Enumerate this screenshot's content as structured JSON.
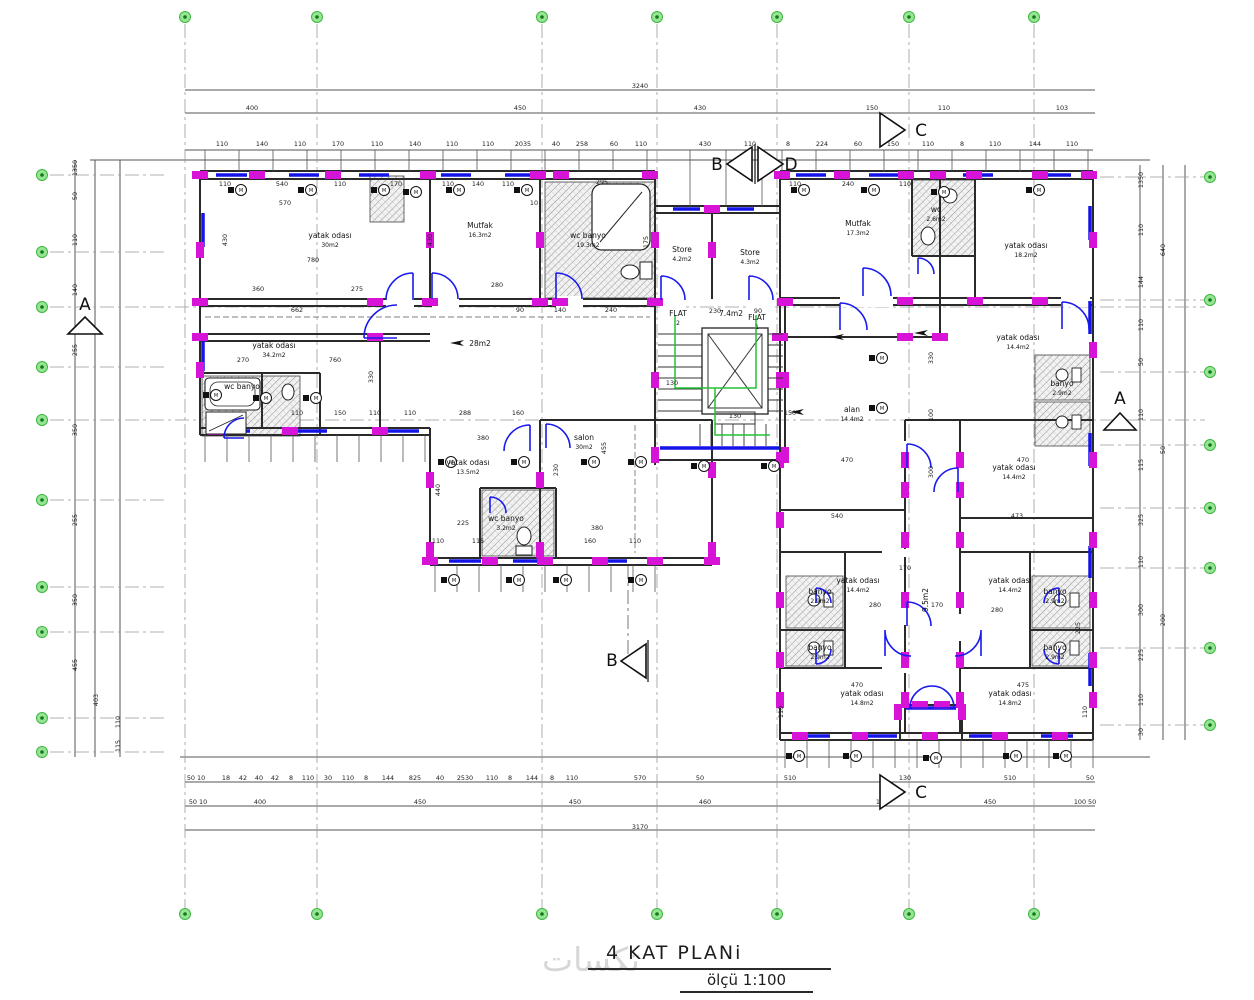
{
  "title": {
    "name": "4 KAT PLANi",
    "scale": "ölçü 1:100"
  },
  "watermark": "تكسات",
  "colors": {
    "wall": "#2a2a2a",
    "column": "#d613d6",
    "window": "#1414e8",
    "door": "#1a1aee",
    "grid_fill": "#97e497",
    "grid_ring": "#3cb83c",
    "grid_dot": "#137a13",
    "escape_path": "#23c035",
    "dim_text": "#1c1c1c",
    "hatch_line": "#8f8f8f",
    "frame": "#555555"
  },
  "icons": {
    "fixture_glyph": "M",
    "direction_arrow": "left-arrow"
  },
  "grid_bubbles": {
    "top": {
      "y": 17,
      "xs": [
        185,
        317,
        542,
        657,
        777,
        909,
        1034
      ]
    },
    "bottom": {
      "y": 914,
      "xs": [
        185,
        317,
        542,
        657,
        777,
        909,
        1034
      ]
    },
    "left": {
      "x": 42,
      "ys": [
        175,
        252,
        307,
        367,
        420,
        500,
        587,
        632,
        718,
        752
      ]
    },
    "right": {
      "x": 1210,
      "ys": [
        177,
        300,
        372,
        445,
        508,
        568,
        648,
        725
      ]
    }
  },
  "section_markers": [
    {
      "label": "A",
      "lx": 85,
      "ly": 310,
      "tri": [
        68,
        334,
        102,
        334,
        85,
        317
      ]
    },
    {
      "label": "A",
      "lx": 1120,
      "ly": 404,
      "tri": [
        1104,
        430,
        1136,
        430,
        1120,
        413
      ]
    },
    {
      "label": "B",
      "lx": 612,
      "ly": 666,
      "tri": [
        646,
        644,
        646,
        678,
        621,
        661
      ]
    },
    {
      "label": "B",
      "lx": 717,
      "ly": 170,
      "tri": [
        752,
        147,
        752,
        181,
        727,
        164
      ]
    },
    {
      "label": "D",
      "lx": 791,
      "ly": 170,
      "tri": [
        758,
        147,
        758,
        181,
        783,
        164
      ]
    },
    {
      "label": "C",
      "lx": 921,
      "ly": 136,
      "tri": [
        880,
        113,
        880,
        147,
        905,
        130
      ]
    },
    {
      "label": "C",
      "lx": 921,
      "ly": 798,
      "tri": [
        880,
        775,
        880,
        809,
        905,
        792
      ]
    }
  ],
  "room_labels": [
    {
      "x": 330,
      "y": 238,
      "name": "yatak odası",
      "area": "30m2"
    },
    {
      "x": 480,
      "y": 228,
      "name": "Mutfak",
      "area": "16.3m2"
    },
    {
      "x": 588,
      "y": 238,
      "name": "wc banyo",
      "area": "19.3m2"
    },
    {
      "x": 682,
      "y": 252,
      "name": "Store",
      "area": "4.2m2"
    },
    {
      "x": 750,
      "y": 255,
      "name": "Store",
      "area": "4.3m2"
    },
    {
      "x": 858,
      "y": 226,
      "name": "Mutfak",
      "area": "17.3m2"
    },
    {
      "x": 1026,
      "y": 248,
      "name": "yatak odası",
      "area": "18.2m2"
    },
    {
      "x": 274,
      "y": 348,
      "name": "yatak odası",
      "area": "34.2m2"
    },
    {
      "x": 480,
      "y": 346,
      "name": "28m2",
      "area": ""
    },
    {
      "x": 242,
      "y": 389,
      "name": "wc banyo",
      "area": ""
    },
    {
      "x": 468,
      "y": 465,
      "name": "yatak odası",
      "area": "13.5m2"
    },
    {
      "x": 584,
      "y": 440,
      "name": "salon",
      "area": "30m2"
    },
    {
      "x": 506,
      "y": 521,
      "name": "wc banyo",
      "area": "3.2m2"
    },
    {
      "x": 678,
      "y": 316,
      "name": "FLAT",
      "area": "2"
    },
    {
      "x": 757,
      "y": 320,
      "name": "FLAT",
      "area": "1"
    },
    {
      "x": 731,
      "y": 316,
      "name": "7.4m2",
      "area": ""
    },
    {
      "x": 852,
      "y": 412,
      "name": "alan",
      "area": "14.4m2"
    },
    {
      "x": 1018,
      "y": 340,
      "name": "yatak odası",
      "area": "14.4m2"
    },
    {
      "x": 1014,
      "y": 470,
      "name": "yatak odası",
      "area": "14.4m2"
    },
    {
      "x": 858,
      "y": 583,
      "name": "yatak odası",
      "area": "14.4m2"
    },
    {
      "x": 1010,
      "y": 583,
      "name": "yatak odası",
      "area": "14.4m2"
    },
    {
      "x": 862,
      "y": 696,
      "name": "yatak odası",
      "area": "14.8m2"
    },
    {
      "x": 1010,
      "y": 696,
      "name": "yatak odası",
      "area": "14.8m2"
    },
    {
      "x": 820,
      "y": 594,
      "name": "banyo",
      "area": "2.9m2"
    },
    {
      "x": 1055,
      "y": 594,
      "name": "banyo",
      "area": "2.9m2"
    },
    {
      "x": 820,
      "y": 650,
      "name": "banyo",
      "area": "2.9m2"
    },
    {
      "x": 1055,
      "y": 650,
      "name": "banyo",
      "area": "2.9m2"
    },
    {
      "x": 1062,
      "y": 386,
      "name": "banyo",
      "area": "2.9m2"
    },
    {
      "x": 936,
      "y": 212,
      "name": "wc",
      "area": "2.6m2"
    },
    {
      "x": 928,
      "y": 600,
      "name": "9.5m2",
      "area": "",
      "rot": 1
    }
  ],
  "dim_labels": [
    [
      640,
      88,
      "3240"
    ],
    [
      252,
      110,
      "400"
    ],
    [
      520,
      110,
      "450"
    ],
    [
      700,
      110,
      "430"
    ],
    [
      872,
      110,
      "150"
    ],
    [
      944,
      110,
      "110"
    ],
    [
      1062,
      110,
      "103"
    ],
    [
      222,
      146,
      "110"
    ],
    [
      262,
      146,
      "140"
    ],
    [
      300,
      146,
      "110"
    ],
    [
      338,
      146,
      "170"
    ],
    [
      377,
      146,
      "110"
    ],
    [
      415,
      146,
      "140"
    ],
    [
      452,
      146,
      "110"
    ],
    [
      488,
      146,
      "110"
    ],
    [
      523,
      146,
      "2035"
    ],
    [
      556,
      146,
      "40"
    ],
    [
      582,
      146,
      "258"
    ],
    [
      614,
      146,
      "60"
    ],
    [
      641,
      146,
      "110"
    ],
    [
      705,
      146,
      "430"
    ],
    [
      750,
      146,
      "110"
    ],
    [
      788,
      146,
      "8"
    ],
    [
      822,
      146,
      "224"
    ],
    [
      858,
      146,
      "60"
    ],
    [
      893,
      146,
      "150"
    ],
    [
      928,
      146,
      "110"
    ],
    [
      962,
      146,
      "8"
    ],
    [
      995,
      146,
      "110"
    ],
    [
      1035,
      146,
      "144"
    ],
    [
      1072,
      146,
      "110"
    ],
    [
      225,
      186,
      "110"
    ],
    [
      282,
      186,
      "540"
    ],
    [
      340,
      186,
      "110"
    ],
    [
      396,
      186,
      "170"
    ],
    [
      448,
      186,
      "110"
    ],
    [
      478,
      186,
      "140"
    ],
    [
      508,
      186,
      "110"
    ],
    [
      602,
      184,
      "295"
    ],
    [
      795,
      186,
      "110"
    ],
    [
      848,
      186,
      "240"
    ],
    [
      905,
      186,
      "110"
    ],
    [
      285,
      205,
      "570"
    ],
    [
      534,
      205,
      "10"
    ],
    [
      313,
      262,
      "780"
    ],
    [
      497,
      287,
      "280"
    ],
    [
      611,
      312,
      "240"
    ],
    [
      258,
      291,
      "360"
    ],
    [
      357,
      291,
      "275"
    ],
    [
      297,
      312,
      "662"
    ],
    [
      520,
      312,
      "90"
    ],
    [
      560,
      312,
      "140"
    ],
    [
      715,
      313,
      "230"
    ],
    [
      758,
      313,
      "90"
    ],
    [
      227,
      240,
      "430",
      1
    ],
    [
      432,
      240,
      "430",
      1
    ],
    [
      648,
      242,
      "175",
      1
    ],
    [
      243,
      362,
      "270"
    ],
    [
      335,
      362,
      "760"
    ],
    [
      373,
      377,
      "330",
      1
    ],
    [
      297,
      415,
      "110"
    ],
    [
      340,
      415,
      "150"
    ],
    [
      375,
      415,
      "110"
    ],
    [
      410,
      415,
      "110"
    ],
    [
      465,
      415,
      "288"
    ],
    [
      518,
      415,
      "160"
    ],
    [
      483,
      440,
      "380"
    ],
    [
      440,
      490,
      "440",
      1
    ],
    [
      463,
      525,
      "225"
    ],
    [
      438,
      543,
      "110"
    ],
    [
      478,
      543,
      "115"
    ],
    [
      597,
      530,
      "380"
    ],
    [
      590,
      543,
      "160"
    ],
    [
      635,
      543,
      "110"
    ],
    [
      558,
      470,
      "230",
      1
    ],
    [
      606,
      448,
      "455",
      1
    ],
    [
      672,
      385,
      "130"
    ],
    [
      735,
      418,
      "130"
    ],
    [
      790,
      415,
      "150"
    ],
    [
      847,
      462,
      "470"
    ],
    [
      837,
      518,
      "540"
    ],
    [
      1017,
      518,
      "473"
    ],
    [
      1023,
      462,
      "470"
    ],
    [
      933,
      358,
      "330",
      1
    ],
    [
      933,
      415,
      "100",
      1
    ],
    [
      933,
      472,
      "300",
      1
    ],
    [
      875,
      607,
      "280"
    ],
    [
      937,
      607,
      "170"
    ],
    [
      997,
      612,
      "280"
    ],
    [
      857,
      687,
      "470"
    ],
    [
      1023,
      687,
      "475"
    ],
    [
      1080,
      628,
      "225",
      1
    ],
    [
      783,
      712,
      "110",
      1
    ],
    [
      1087,
      712,
      "110",
      1
    ],
    [
      905,
      570,
      "170"
    ],
    [
      77,
      168,
      "1350",
      1
    ],
    [
      77,
      196,
      "50",
      1
    ],
    [
      77,
      240,
      "110",
      1
    ],
    [
      77,
      290,
      "140",
      1
    ],
    [
      77,
      350,
      "255",
      1
    ],
    [
      77,
      430,
      "350",
      1
    ],
    [
      77,
      520,
      "255",
      1
    ],
    [
      77,
      600,
      "350",
      1
    ],
    [
      77,
      665,
      "455",
      1
    ],
    [
      98,
      700,
      "403",
      1
    ],
    [
      120,
      722,
      "110",
      1
    ],
    [
      120,
      746,
      "115",
      1
    ],
    [
      1143,
      180,
      "1350",
      1
    ],
    [
      1143,
      230,
      "110",
      1
    ],
    [
      1143,
      282,
      "144",
      1
    ],
    [
      1143,
      325,
      "110",
      1
    ],
    [
      1143,
      362,
      "50",
      1
    ],
    [
      1143,
      415,
      "110",
      1
    ],
    [
      1143,
      465,
      "115",
      1
    ],
    [
      1143,
      520,
      "325",
      1
    ],
    [
      1143,
      562,
      "110",
      1
    ],
    [
      1143,
      610,
      "300",
      1
    ],
    [
      1143,
      655,
      "225",
      1
    ],
    [
      1143,
      700,
      "110",
      1
    ],
    [
      1143,
      732,
      "30",
      1
    ],
    [
      1165,
      250,
      "640",
      1
    ],
    [
      1165,
      450,
      "50",
      1
    ],
    [
      1165,
      620,
      "200",
      1
    ],
    [
      196,
      780,
      "50 10"
    ],
    [
      226,
      780,
      "18"
    ],
    [
      243,
      780,
      "42"
    ],
    [
      259,
      780,
      "40"
    ],
    [
      275,
      780,
      "42"
    ],
    [
      291,
      780,
      "8"
    ],
    [
      308,
      780,
      "110"
    ],
    [
      328,
      780,
      "30"
    ],
    [
      348,
      780,
      "110"
    ],
    [
      366,
      780,
      "8"
    ],
    [
      388,
      780,
      "144"
    ],
    [
      415,
      780,
      "825"
    ],
    [
      440,
      780,
      "40"
    ],
    [
      465,
      780,
      "2530"
    ],
    [
      492,
      780,
      "110"
    ],
    [
      510,
      780,
      "8"
    ],
    [
      532,
      780,
      "144"
    ],
    [
      552,
      780,
      "8"
    ],
    [
      572,
      780,
      "110"
    ],
    [
      640,
      780,
      "570"
    ],
    [
      700,
      780,
      "50"
    ],
    [
      790,
      780,
      "510"
    ],
    [
      905,
      780,
      "130"
    ],
    [
      1010,
      780,
      "510"
    ],
    [
      1090,
      780,
      "50"
    ],
    [
      198,
      804,
      "50 10"
    ],
    [
      260,
      804,
      "400"
    ],
    [
      420,
      804,
      "450"
    ],
    [
      575,
      804,
      "450"
    ],
    [
      705,
      804,
      "460"
    ],
    [
      882,
      804,
      "147"
    ],
    [
      990,
      804,
      "450"
    ],
    [
      1085,
      804,
      "100 50"
    ],
    [
      640,
      829,
      "3170"
    ]
  ]
}
